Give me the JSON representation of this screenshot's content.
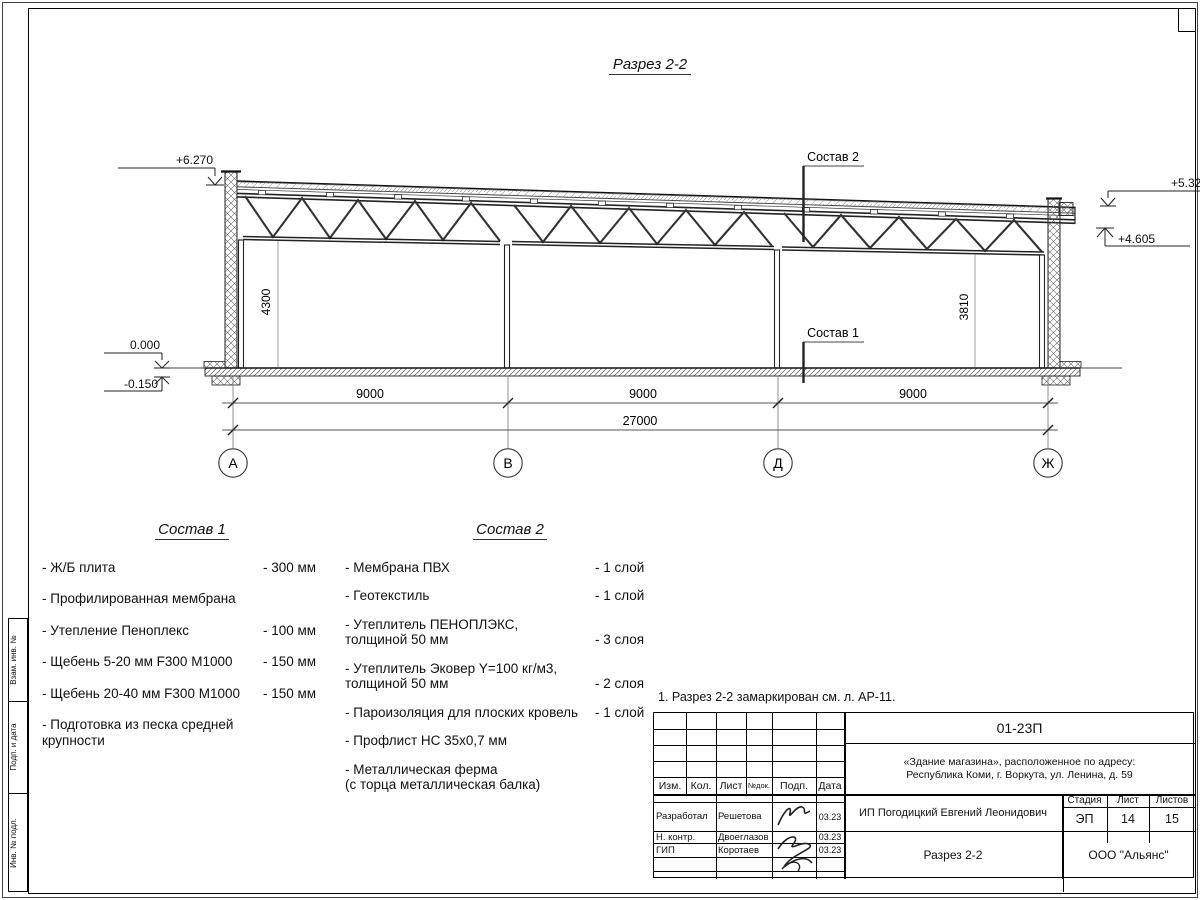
{
  "drawing": {
    "title": "Разрез 2-2",
    "elev_plus6270": "+6.270",
    "elev_plus5327": "+5.327",
    "elev_plus4605": "+4.605",
    "elev_zero": "0.000",
    "elev_minus0150": "-0.150",
    "dim_left_height": "4300",
    "dim_right_height": "3810",
    "span1": "9000",
    "span2": "9000",
    "span3": "9000",
    "total": "27000",
    "axis1": "А",
    "axis2": "В",
    "axis3": "Д",
    "axis4": "Ж",
    "callout_roof": "Состав 2",
    "callout_floor": "Состав 1"
  },
  "note": "1. Разрез 2-2 замаркирован см. л. АР-11.",
  "comp1": {
    "title": "Состав 1",
    "items": [
      {
        "n": "- Ж/Б плита",
        "v": "- 300 мм"
      },
      {
        "n": "- Профилированная мембрана",
        "v": ""
      },
      {
        "n": "- Утепление Пеноплекс",
        "v": "- 100 мм"
      },
      {
        "n": "-  Щебень 5-20 мм F300 М1000",
        "v": "- 150 мм"
      },
      {
        "n": "-  Щебень 20-40 мм F300 М1000",
        "v": "- 150 мм"
      },
      {
        "n": "- Подготовка из песка средней\nкрупности",
        "v": ""
      }
    ]
  },
  "comp2": {
    "title": "Состав 2",
    "items": [
      {
        "n": "- Мембрана ПВХ",
        "v": "- 1 слой"
      },
      {
        "n": "- Геотекстиль",
        "v": "- 1 слой"
      },
      {
        "n": "- Утеплитель ПЕНОПЛЭКС,\nтолщиной 50 мм",
        "v": "- 3 слоя"
      },
      {
        "n": "- Утеплитель Эковер Y=100 кг/м3,\nтолщиной 50 мм",
        "v": "- 2 слоя"
      },
      {
        "n": "- Пароизоляция для плоских кровель",
        "v": "- 1 слой"
      },
      {
        "n": "- Профлист НС 35х0,7 мм",
        "v": ""
      },
      {
        "n": "- Металлическая ферма\n(с торца металлическая балка)",
        "v": ""
      }
    ]
  },
  "titleblock": {
    "doc_number": "01-23П",
    "object": "«Здание магазина», расположенное по адресу:\nРеспублика Коми, г. Воркута, ул. Ленина, д. 59",
    "col_izm": "Изм.",
    "col_kol": "Кол.",
    "col_list": "Лист",
    "col_ndok": "№док.",
    "col_podp": "Подп.",
    "col_data": "Дата",
    "row1_role": "Разработал",
    "row1_name": "Решетова",
    "row1_date": "03.23",
    "row2_role": "Н. контр.",
    "row2_name": "Двоеглазов",
    "row2_date": "03.23",
    "row3_role": "ГИП",
    "row3_name": "Коротаев",
    "row3_date": "03.23",
    "customer": "ИП Погодицкий Евгений Леонидович",
    "stage_label": "Стадия",
    "sheet_label": "Лист",
    "sheets_label": "Листов",
    "stage": "ЭП",
    "sheet": "14",
    "sheets": "15",
    "drawing_name": "Разрез 2-2",
    "company": "ООО \"Альянс\""
  },
  "margin": {
    "l1": "Взам. инв. №",
    "l2": "Подп. и дата",
    "l3": "Инв. № подл."
  }
}
